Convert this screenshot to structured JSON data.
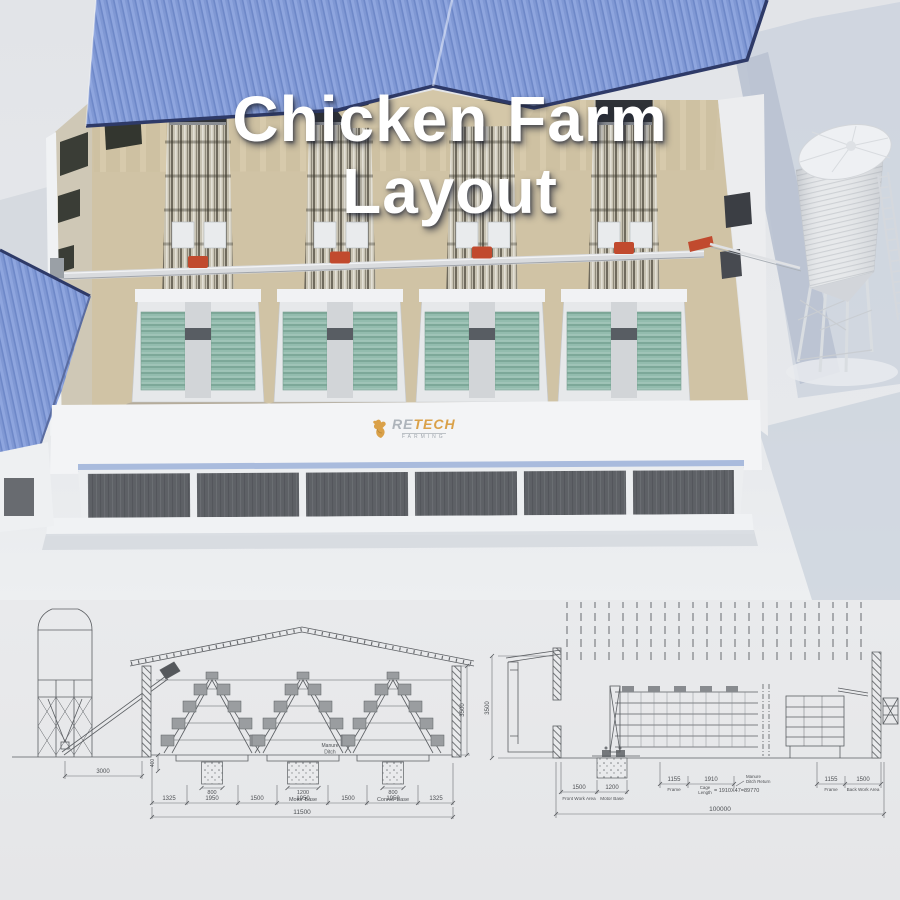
{
  "title": {
    "line1": "Chicken Farm",
    "line2": "Layout"
  },
  "logo": {
    "brand_left": "RE",
    "brand_right": "TECH",
    "subtitle": "FARMING"
  },
  "colors": {
    "roof_blue": "#8098d4",
    "roof_edge_navy": "#2e3a68",
    "floor_tan": "#d0c3a5",
    "belt_green": "#8fb8aa",
    "accent_orange": "#c14a2e",
    "logo_gold": "#d89a3b",
    "panel_gray": "#5f6267",
    "drawing_line": "#5b5e62"
  },
  "left_drawing": {
    "dim_silo_offset": "3000",
    "dim_pit_depth": "400",
    "dim_base_left": "800",
    "dim_base_motor": "1200",
    "dim_base_corner": "800",
    "manure_ditch_line1": "Manure",
    "manure_ditch_line2": "Ditch",
    "label_motor_base": "Motor Base",
    "label_corner_base": "Conner Base",
    "dim_wall_height": "3500",
    "spans": [
      "1325",
      "1950",
      "1500",
      "1950",
      "1500",
      "1950",
      "1325"
    ],
    "dim_total_width": "11500"
  },
  "right_drawing": {
    "dim_wall_height": "3500",
    "dim_front_work": "1500",
    "label_front_work": "Front Work Area",
    "dim_motor_base": "1200",
    "label_motor_base": "Motor Base",
    "dim_frame_left": "1155",
    "label_frame_left": "Frame",
    "dim_cage": "1910",
    "label_cage_line1": "Cage",
    "label_cage_line2": "Length",
    "cage_formula": "= 1910X47=89770",
    "manure_return_line1": "Manure",
    "manure_return_line2": "Ditch Return",
    "dim_frame_right": "1155",
    "label_frame_right": "Frame",
    "dim_back_work": "1500",
    "label_back_work": "Back Work Area",
    "dim_total_length": "100000"
  }
}
